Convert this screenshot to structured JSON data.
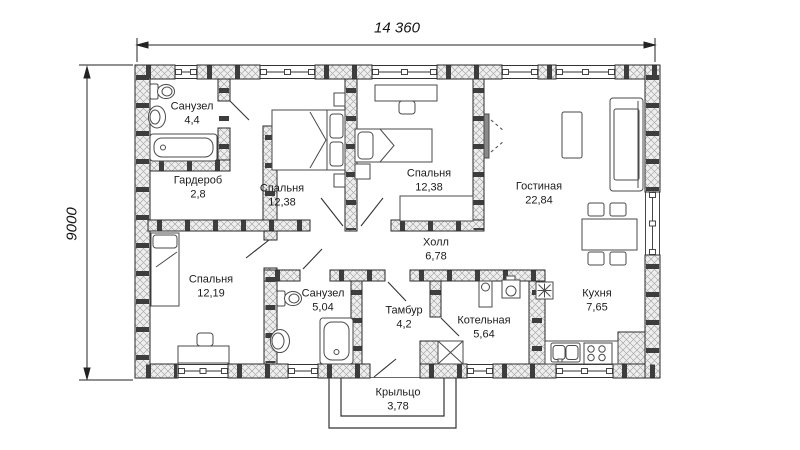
{
  "plan": {
    "dimensions": {
      "width_label": "14 360",
      "height_label": "9000"
    },
    "rooms": [
      {
        "id": "bathroom-1",
        "name": "Санузел",
        "area": "4,4"
      },
      {
        "id": "wardrobe",
        "name": "Гардероб",
        "area": "2,8"
      },
      {
        "id": "bedroom-1",
        "name": "Спальня",
        "area": "12,38"
      },
      {
        "id": "bedroom-2",
        "name": "Спальня",
        "area": "12,38"
      },
      {
        "id": "living-room",
        "name": "Гостиная",
        "area": "22,84"
      },
      {
        "id": "bedroom-3",
        "name": "Спальня",
        "area": "12,19"
      },
      {
        "id": "bathroom-2",
        "name": "Санузел",
        "area": "5,04"
      },
      {
        "id": "hall",
        "name": "Холл",
        "area": "6,78"
      },
      {
        "id": "vestibule",
        "name": "Тамбур",
        "area": "4,2"
      },
      {
        "id": "boiler-room",
        "name": "Котельная",
        "area": "5,64"
      },
      {
        "id": "kitchen",
        "name": "Кухня",
        "area": "7,65"
      },
      {
        "id": "porch",
        "name": "Крыльцо",
        "area": "3,78"
      }
    ],
    "symbols": {
      "ventilation_symbol": "8-point-star",
      "chimney_symbol": "crossed-box"
    },
    "colors": {
      "wall_fill": "#eeeeee",
      "wall_hatch": "#9c9c9c",
      "wall_outline": "#2a2a2a",
      "masonry_joint": "#3d3d3d",
      "furniture_line": "#4a4a4a",
      "text": "#1b1b1b"
    }
  }
}
